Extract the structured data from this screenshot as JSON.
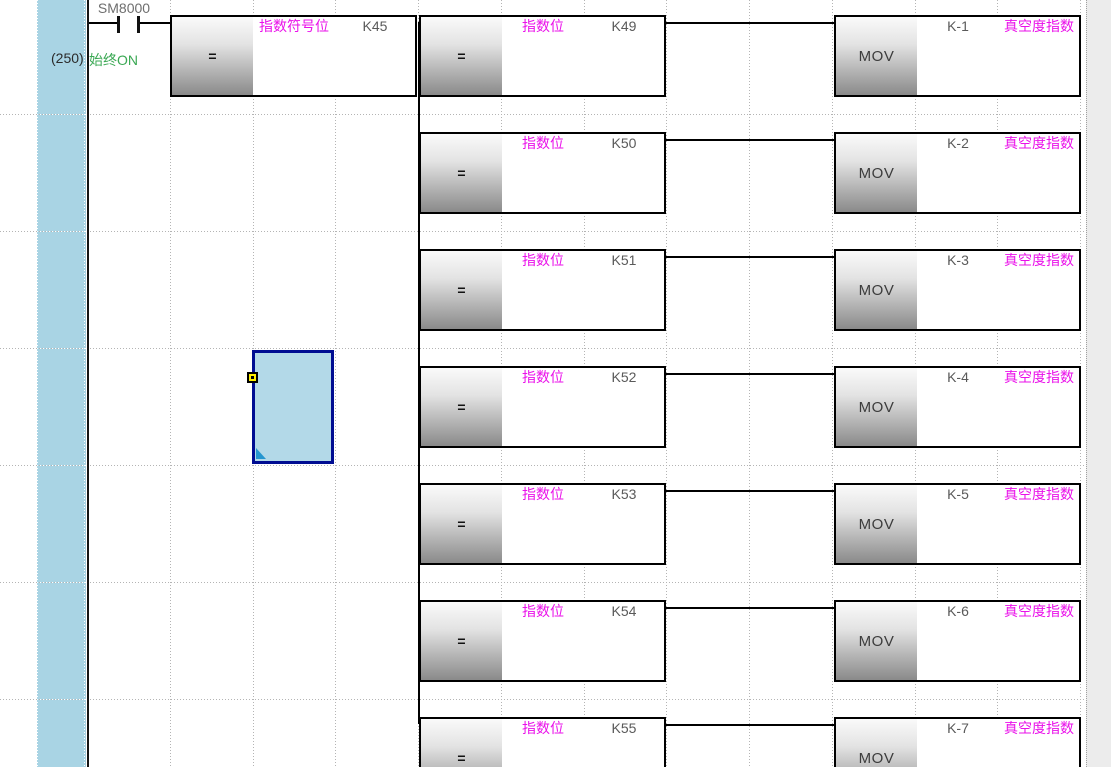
{
  "ladder": {
    "step_number": "(250)",
    "contact_device": "SM8000",
    "contact_comment": "始终ON",
    "first_compare": {
      "mnemonic": "=",
      "label": "指数符号位",
      "operand": "K45"
    },
    "branches": [
      {
        "compare_mnemonic": "=",
        "compare_label": "指数位",
        "compare_operand": "K49",
        "move_mnemonic": "MOV",
        "move_operand": "K-1",
        "move_label": "真空度指数"
      },
      {
        "compare_mnemonic": "=",
        "compare_label": "指数位",
        "compare_operand": "K50",
        "move_mnemonic": "MOV",
        "move_operand": "K-2",
        "move_label": "真空度指数"
      },
      {
        "compare_mnemonic": "=",
        "compare_label": "指数位",
        "compare_operand": "K51",
        "move_mnemonic": "MOV",
        "move_operand": "K-3",
        "move_label": "真空度指数"
      },
      {
        "compare_mnemonic": "=",
        "compare_label": "指数位",
        "compare_operand": "K52",
        "move_mnemonic": "MOV",
        "move_operand": "K-4",
        "move_label": "真空度指数"
      },
      {
        "compare_mnemonic": "=",
        "compare_label": "指数位",
        "compare_operand": "K53",
        "move_mnemonic": "MOV",
        "move_operand": "K-5",
        "move_label": "真空度指数"
      },
      {
        "compare_mnemonic": "=",
        "compare_label": "指数位",
        "compare_operand": "K54",
        "move_mnemonic": "MOV",
        "move_operand": "K-6",
        "move_label": "真空度指数"
      },
      {
        "compare_mnemonic": "=",
        "compare_label": "指数位",
        "compare_operand": "K55",
        "move_mnemonic": "MOV",
        "move_operand": "K-7",
        "move_label": "真空度指数"
      }
    ],
    "selected_branch_index": 3,
    "colors": {
      "accent_magenta": "#ea10ea",
      "comment_green": "#3aa853",
      "margin_blue": "#a9d4e4",
      "selection_fill": "#b3d9e8",
      "selection_border": "#000d92"
    }
  }
}
